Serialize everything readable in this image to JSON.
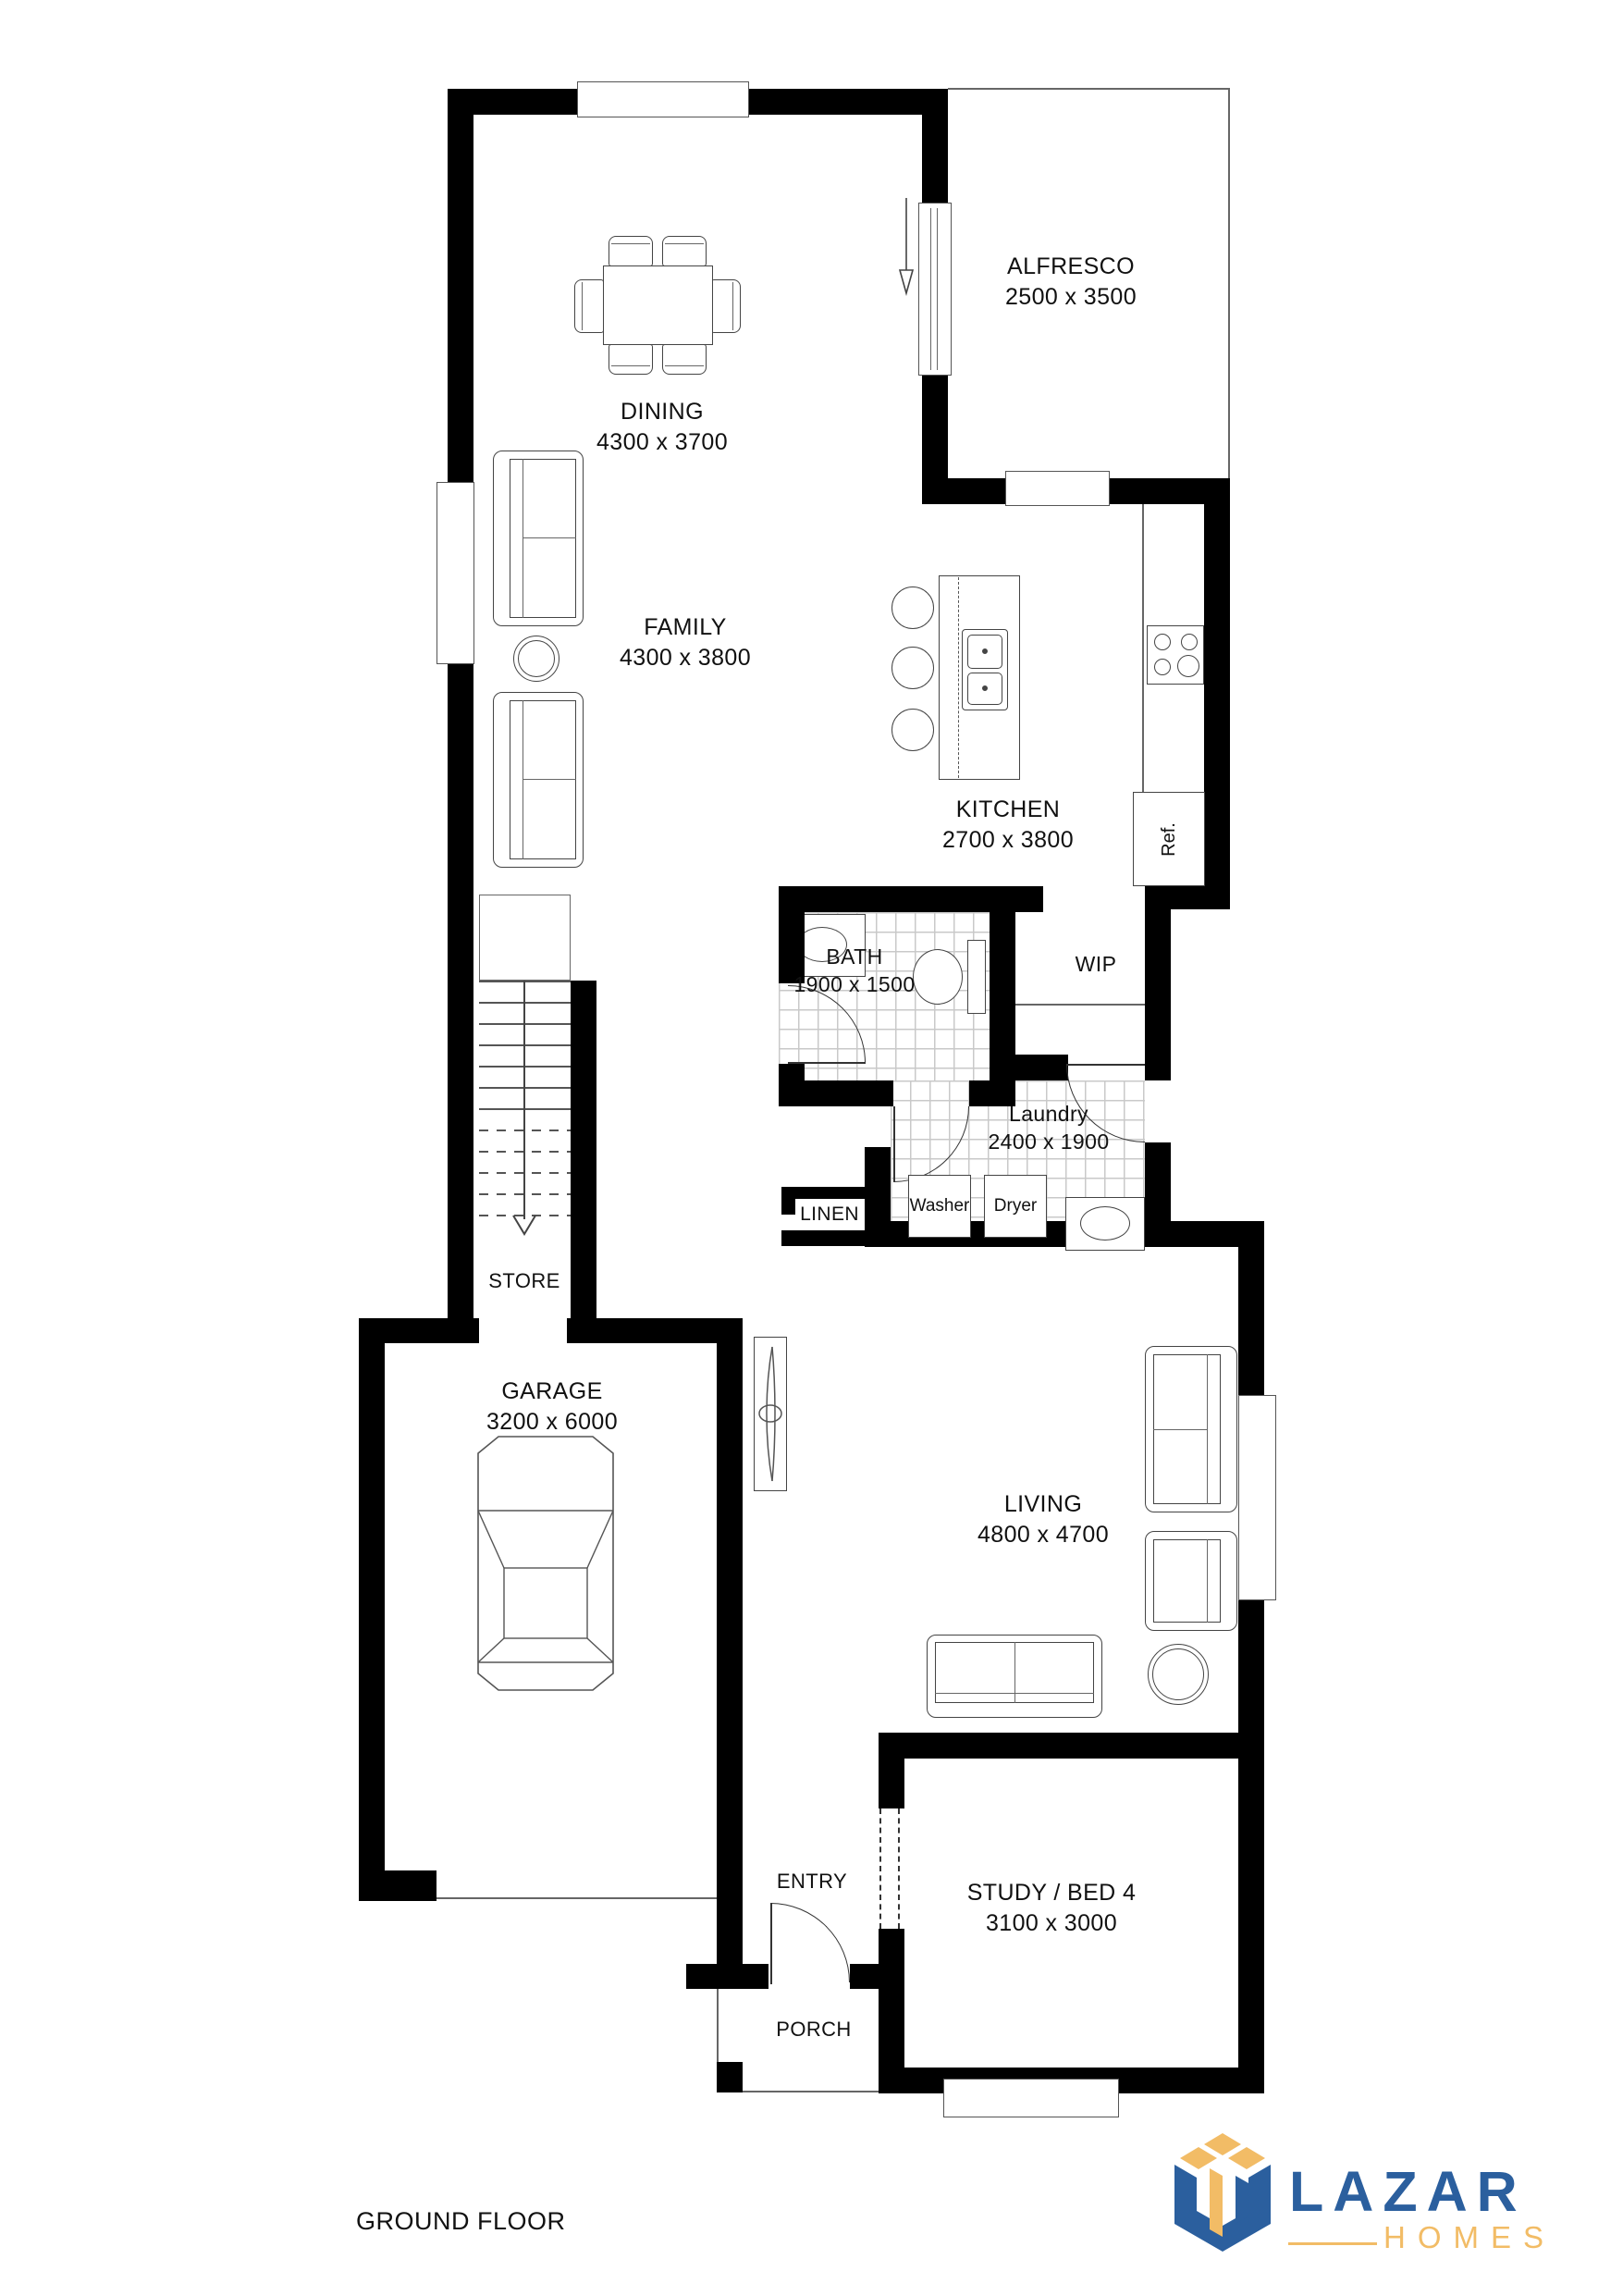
{
  "page": {
    "floor_label": "GROUND FLOOR"
  },
  "brand": {
    "name": "LAZAR",
    "tagline": "HOMES",
    "blue": "#2b5f9e",
    "gold": "#f2bc66"
  },
  "rooms": {
    "dining": {
      "label": "DINING",
      "dims": "4300 x 3700"
    },
    "alfresco": {
      "label": "ALFRESCO",
      "dims": "2500 x 3500"
    },
    "family": {
      "label": "FAMILY",
      "dims": "4300 x 3800"
    },
    "kitchen": {
      "label": "KITCHEN",
      "dims": "2700 x 3800"
    },
    "bath": {
      "label": "BATH",
      "dims": "1900 x 1500"
    },
    "wip": {
      "label": "WIP"
    },
    "laundry": {
      "label": "Laundry",
      "dims": "2400 x 1900"
    },
    "linen": {
      "label": "LINEN"
    },
    "store": {
      "label": "STORE"
    },
    "garage": {
      "label": "GARAGE",
      "dims": "3200 x 6000"
    },
    "living": {
      "label": "LIVING",
      "dims": "4800 x 4700"
    },
    "study": {
      "label": "STUDY / BED 4",
      "dims": "3100 x 3000"
    },
    "entry": {
      "label": "ENTRY"
    },
    "porch": {
      "label": "PORCH"
    }
  },
  "fixtures": {
    "fridge": "Ref.",
    "washer": "Washer",
    "dryer": "Dryer"
  }
}
